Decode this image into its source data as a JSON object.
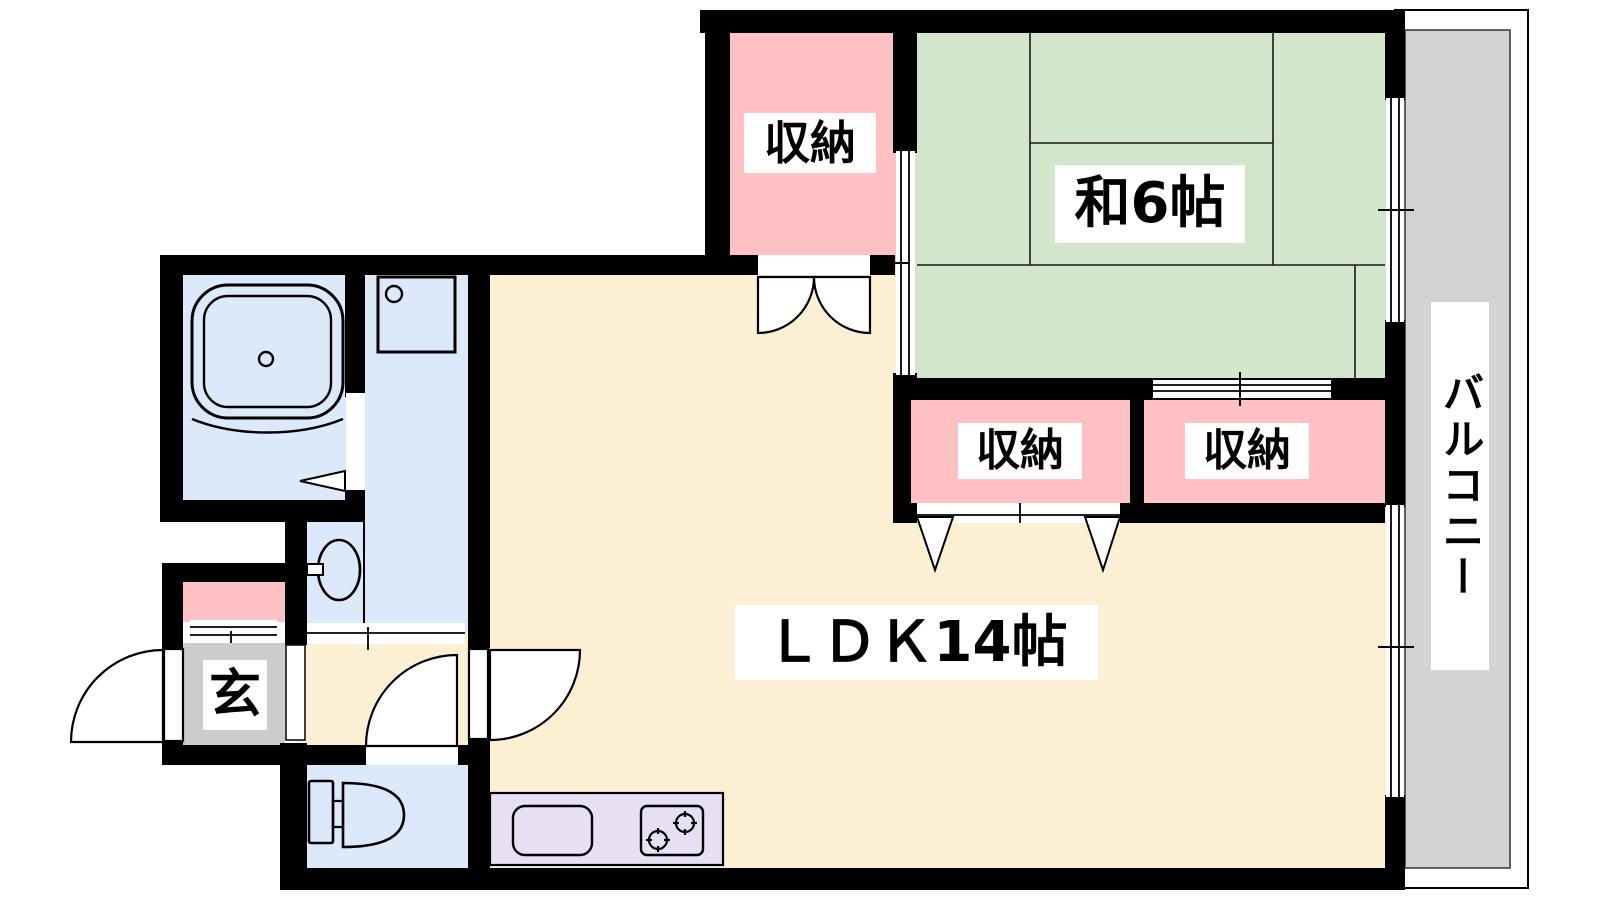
{
  "plan": {
    "rooms": {
      "storage_top": {
        "label": "収納"
      },
      "japanese_room": {
        "label": "和6帖"
      },
      "storage_left": {
        "label": "収納"
      },
      "storage_right": {
        "label": "収納"
      },
      "ldk": {
        "label": "ＬＤＫ14帖"
      },
      "entrance": {
        "label": "玄"
      },
      "balcony": {
        "label": "バルコニー"
      }
    },
    "colors": {
      "wall": "#000000",
      "ldk_floor": "#FDEFD3",
      "tatami_floor": "#D3E6CB",
      "storage_floor": "#FFC1C4",
      "wet_area_floor": "#DCE9FB",
      "entrance_floor": "#CCCCCC",
      "balcony_floor": "#D3D3D3",
      "kitchen_counter": "#E7DFF4"
    },
    "fixtures": [
      "bathtub",
      "washing-machine-pan",
      "washbasin",
      "toilet",
      "kitchen-sink",
      "gas-stove"
    ]
  }
}
